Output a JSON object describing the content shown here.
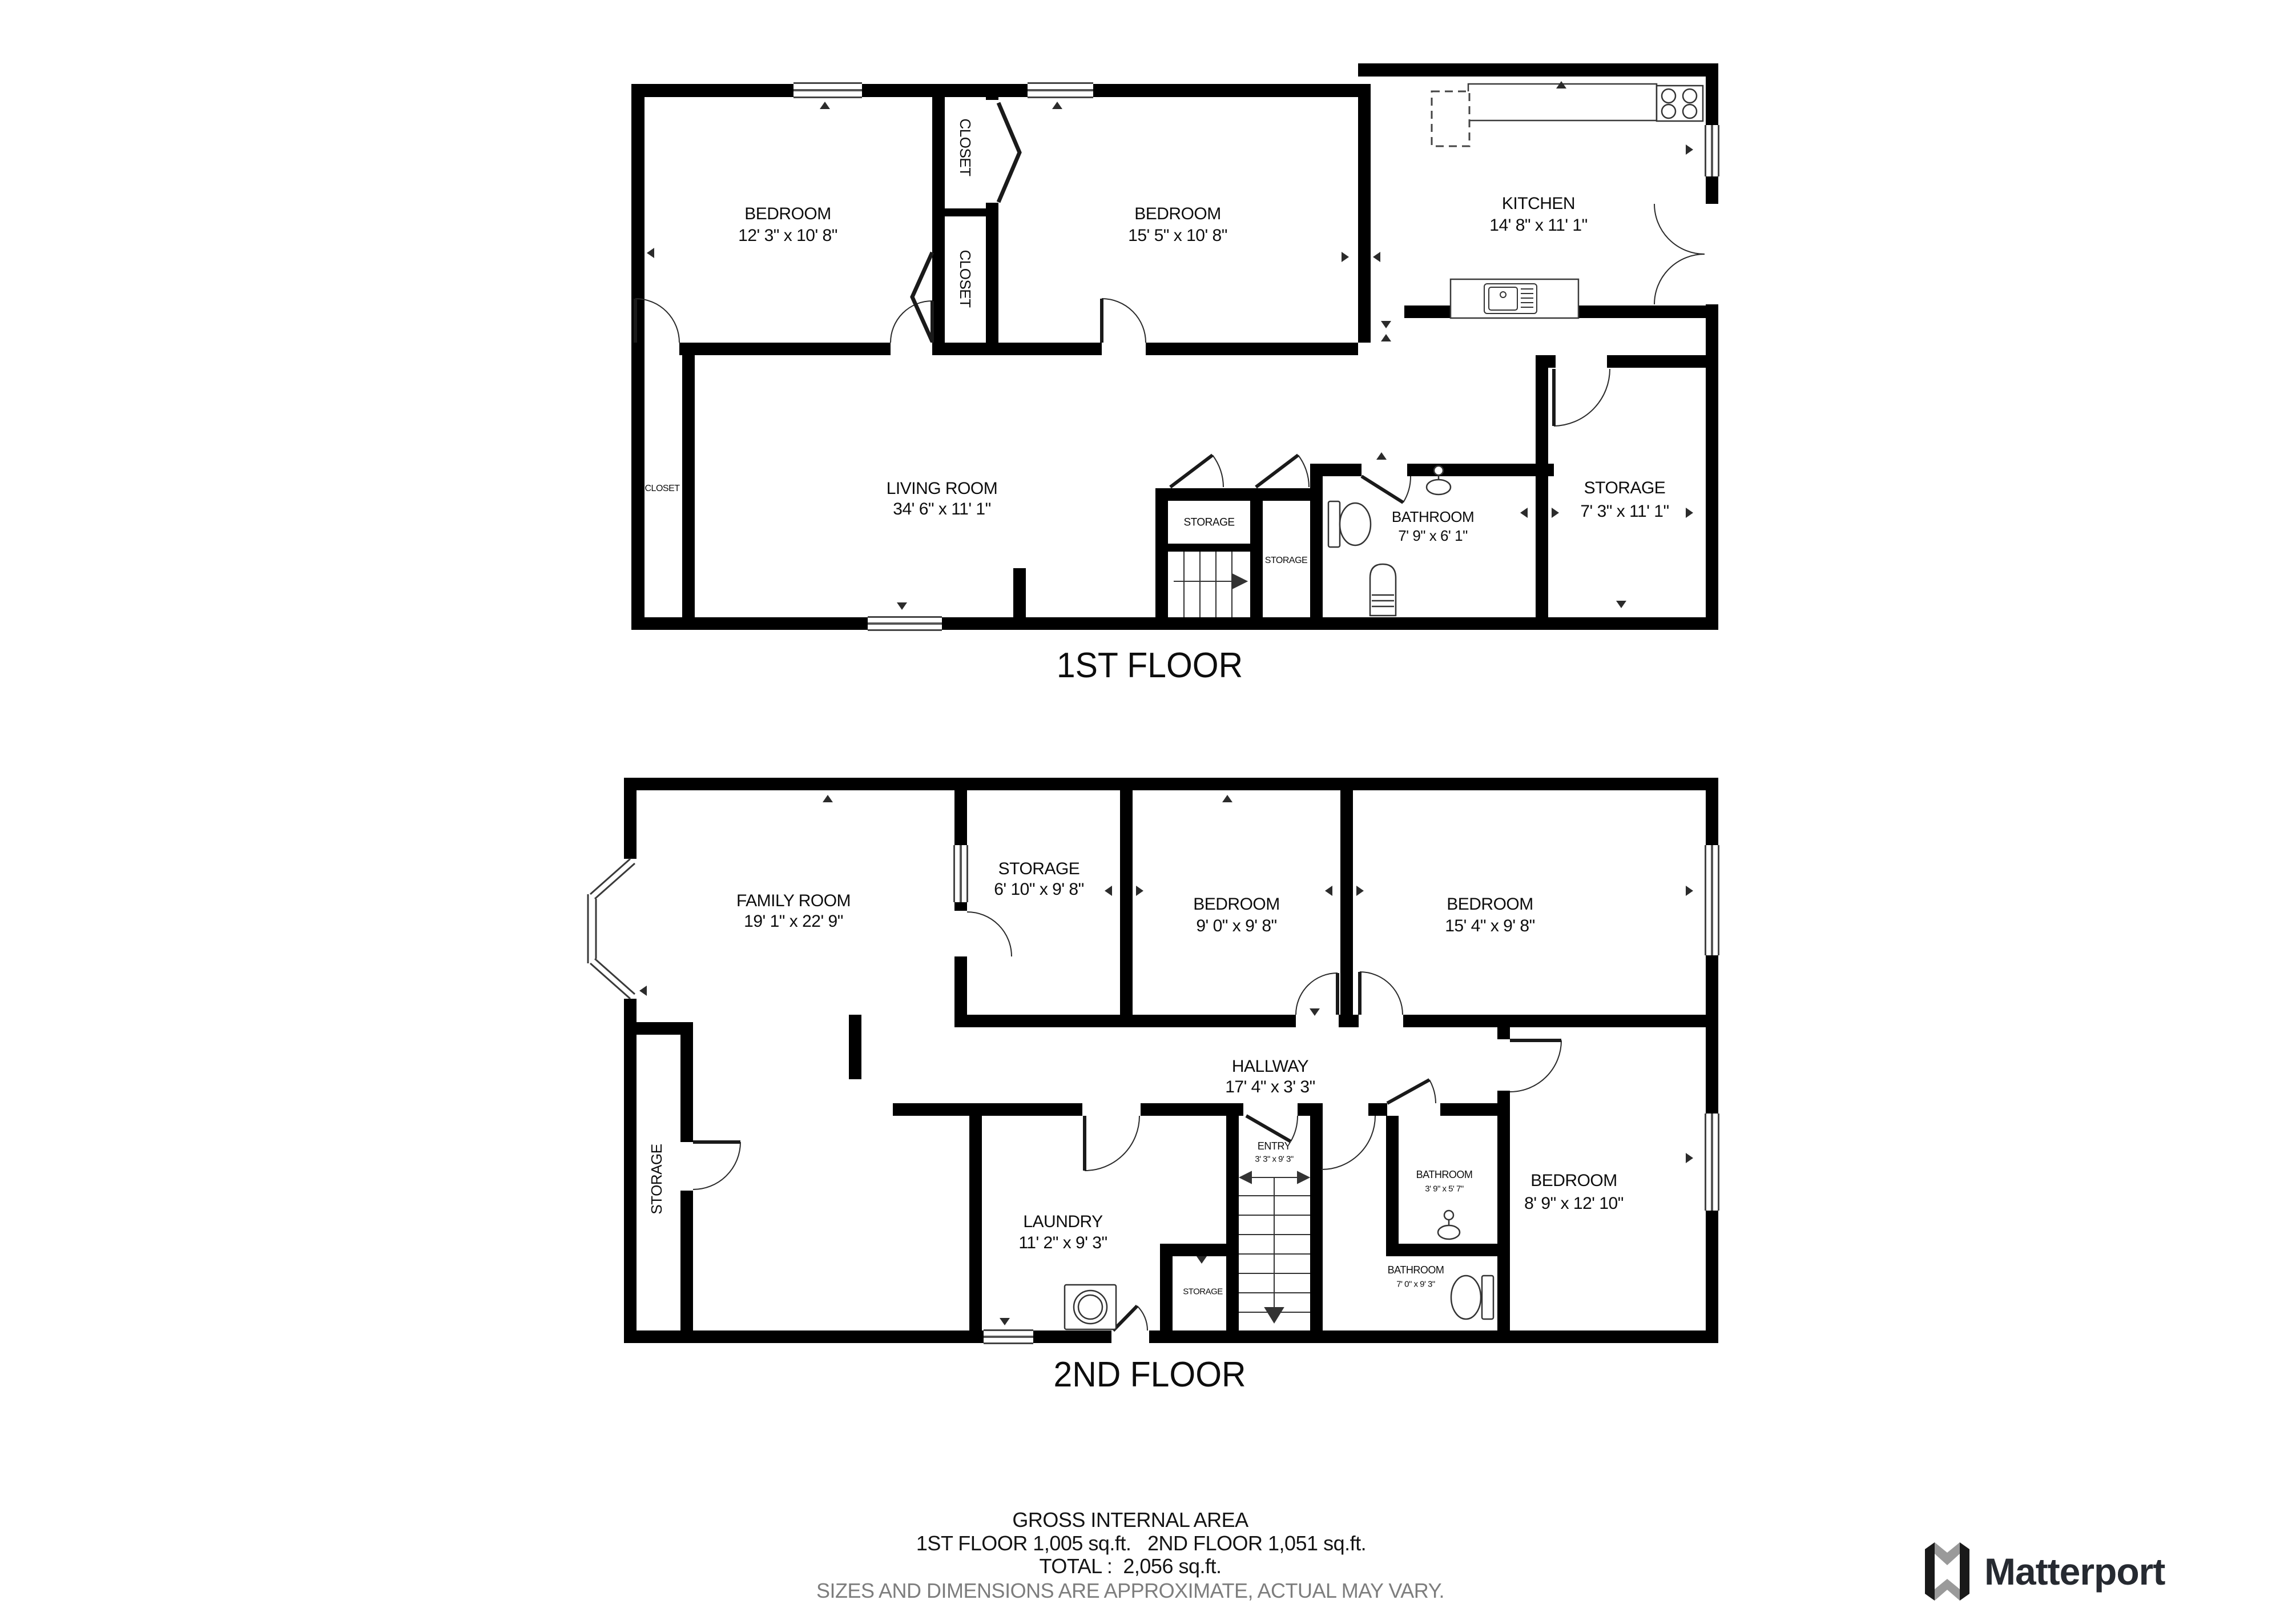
{
  "floors": [
    {
      "title": "1ST FLOOR",
      "rooms": {
        "bedroom_left": {
          "name": "BEDROOM",
          "dims": "12' 3\" x 10' 8\""
        },
        "bedroom_mid": {
          "name": "BEDROOM",
          "dims": "15' 5\" x 10' 8\""
        },
        "kitchen": {
          "name": "KITCHEN",
          "dims": "14' 8\" x 11' 1\""
        },
        "living": {
          "name": "LIVING ROOM",
          "dims": "34' 6\" x 11' 1\""
        },
        "closet_upper": {
          "name": "CLOSET"
        },
        "closet_lower": {
          "name": "CLOSET"
        },
        "closet_hall": {
          "name": "CLOSET"
        },
        "storage_stairs": {
          "name": "STORAGE"
        },
        "storage_mid": {
          "name": "STORAGE"
        },
        "bathroom": {
          "name": "BATHROOM",
          "dims": "7' 9\" x 6' 1\""
        },
        "storage_right": {
          "name": "STORAGE",
          "dims": "7' 3\" x 11' 1\""
        }
      }
    },
    {
      "title": "2ND FLOOR",
      "rooms": {
        "family": {
          "name": "FAMILY ROOM",
          "dims": "19' 1\" x 22' 9\""
        },
        "storage_top": {
          "name": "STORAGE",
          "dims": "6' 10\" x 9' 8\""
        },
        "bedroom_small": {
          "name": "BEDROOM",
          "dims": "9' 0\" x 9' 8\""
        },
        "bedroom_mid": {
          "name": "BEDROOM",
          "dims": "15' 4\" x 9' 8\""
        },
        "hallway": {
          "name": "HALLWAY",
          "dims": "17' 4\" x 3' 3\""
        },
        "entry": {
          "name": "ENTRY",
          "dims": "3' 3\" x 9' 3\""
        },
        "laundry": {
          "name": "LAUNDRY",
          "dims": "11' 2\" x 9' 3\""
        },
        "storage_left": {
          "name": "STORAGE"
        },
        "storage_closet": {
          "name": "STORAGE"
        },
        "bath_small": {
          "name": "BATHROOM",
          "dims": "3' 9\" x 5' 7\""
        },
        "bath_large": {
          "name": "BATHROOM",
          "dims": "7' 0\" x 9' 3\""
        },
        "bedroom_right": {
          "name": "BEDROOM",
          "dims": "8' 9\" x 12' 10\""
        }
      }
    }
  ],
  "footer": {
    "line1": "GROSS INTERNAL AREA",
    "line2a": "1ST FLOOR 1,005 sq.ft.",
    "line2b": "2ND FLOOR 1,051 sq.ft.",
    "line3": "TOTAL :  2,056 sq.ft.",
    "line4": "SIZES AND DIMENSIONS ARE APPROXIMATE, ACTUAL MAY VARY."
  },
  "logo": {
    "text": "Matterport"
  }
}
